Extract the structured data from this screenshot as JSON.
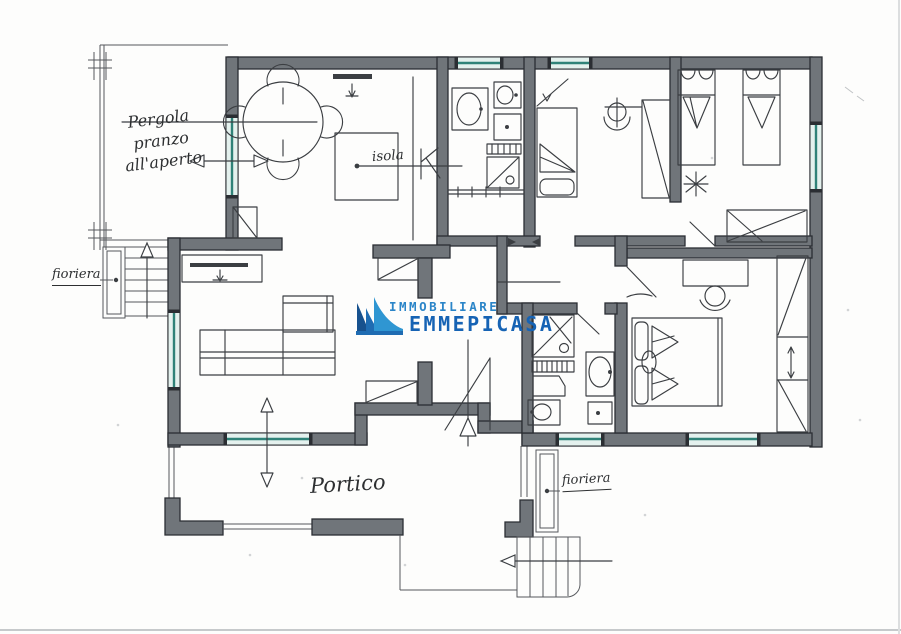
{
  "document": {
    "type_label": "floor-plan"
  },
  "labels": {
    "pergola": "Pergola\npranzo\nall'aperto",
    "fioriera_left": "fioriera",
    "isola": "isola",
    "portico": "Portico",
    "fioriera_bottom": "fioriera"
  },
  "logo": {
    "line1": "IMMOBILIARE",
    "line2": "EMMEPICASA"
  },
  "colors": {
    "wall": "#70757a",
    "wall_outline": "#2b2e33",
    "window_glass": "#e4f1ee",
    "window_frame": "#2f8278",
    "ink": "#3b3e42",
    "background": "#fdfdfc",
    "logo_navy": "#17518e",
    "logo_mid": "#1f6cb2",
    "logo_light": "#2f96d2",
    "logo_text_small": "#2b85c8",
    "logo_text_large": "#1663b4"
  }
}
